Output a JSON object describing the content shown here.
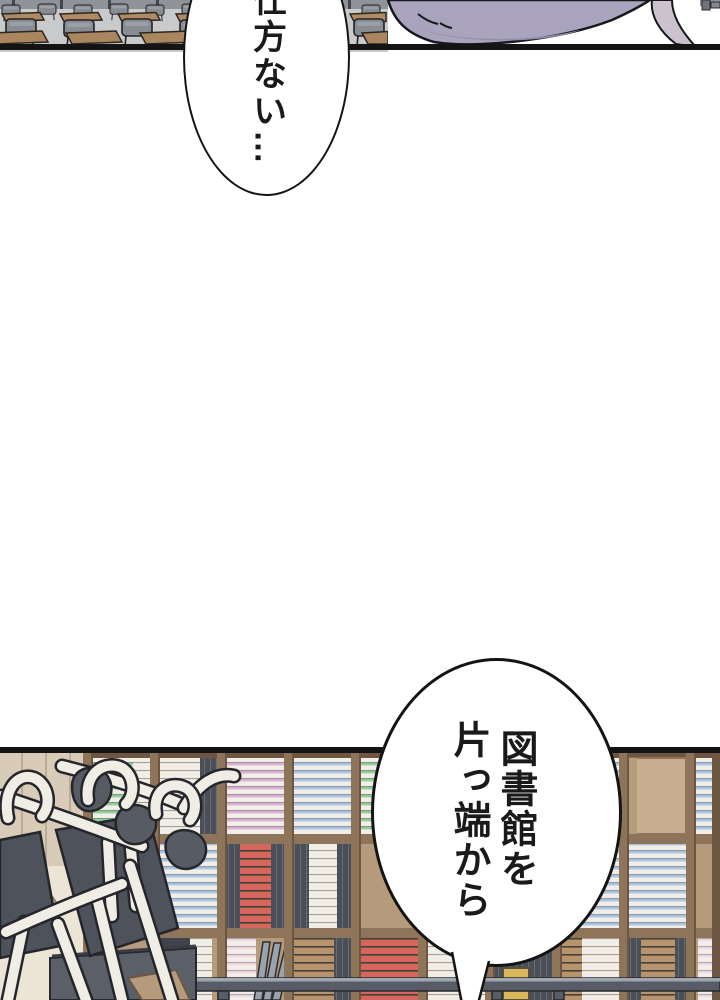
{
  "bubbles": {
    "top": {
      "text": "仕方ない…"
    },
    "bottom": {
      "line1": "図書館を",
      "line2": "片っ端から"
    }
  },
  "panels": {
    "top_scene": "classroom-desks-and-hair",
    "bottom_scene": "library-bookshelves-with-stacked-chairs"
  },
  "colors": {
    "ink": "#141414",
    "hair": "#a9a3bd",
    "hair_shade": "#948eae",
    "hair_strand": "#cbc2cd",
    "wood": "#b69a7c",
    "wood_divider": "#8e755a",
    "wall": "#d8cbb7",
    "wall_lower": "#ece5d6",
    "empty_panel": "#c6ae8f",
    "railing": "#575c66",
    "railing_highlight": "#9fa6b0",
    "desk_slab": "#5a5f68",
    "book_red": "#d5665c",
    "book_blue": "#a6c3e1",
    "book_pink": "#dcb0d2",
    "book_green": "#92cc9c",
    "book_yellow": "#d9b75a",
    "classroom_desk": "#b08a62",
    "classroom_chair": "#888c93"
  }
}
